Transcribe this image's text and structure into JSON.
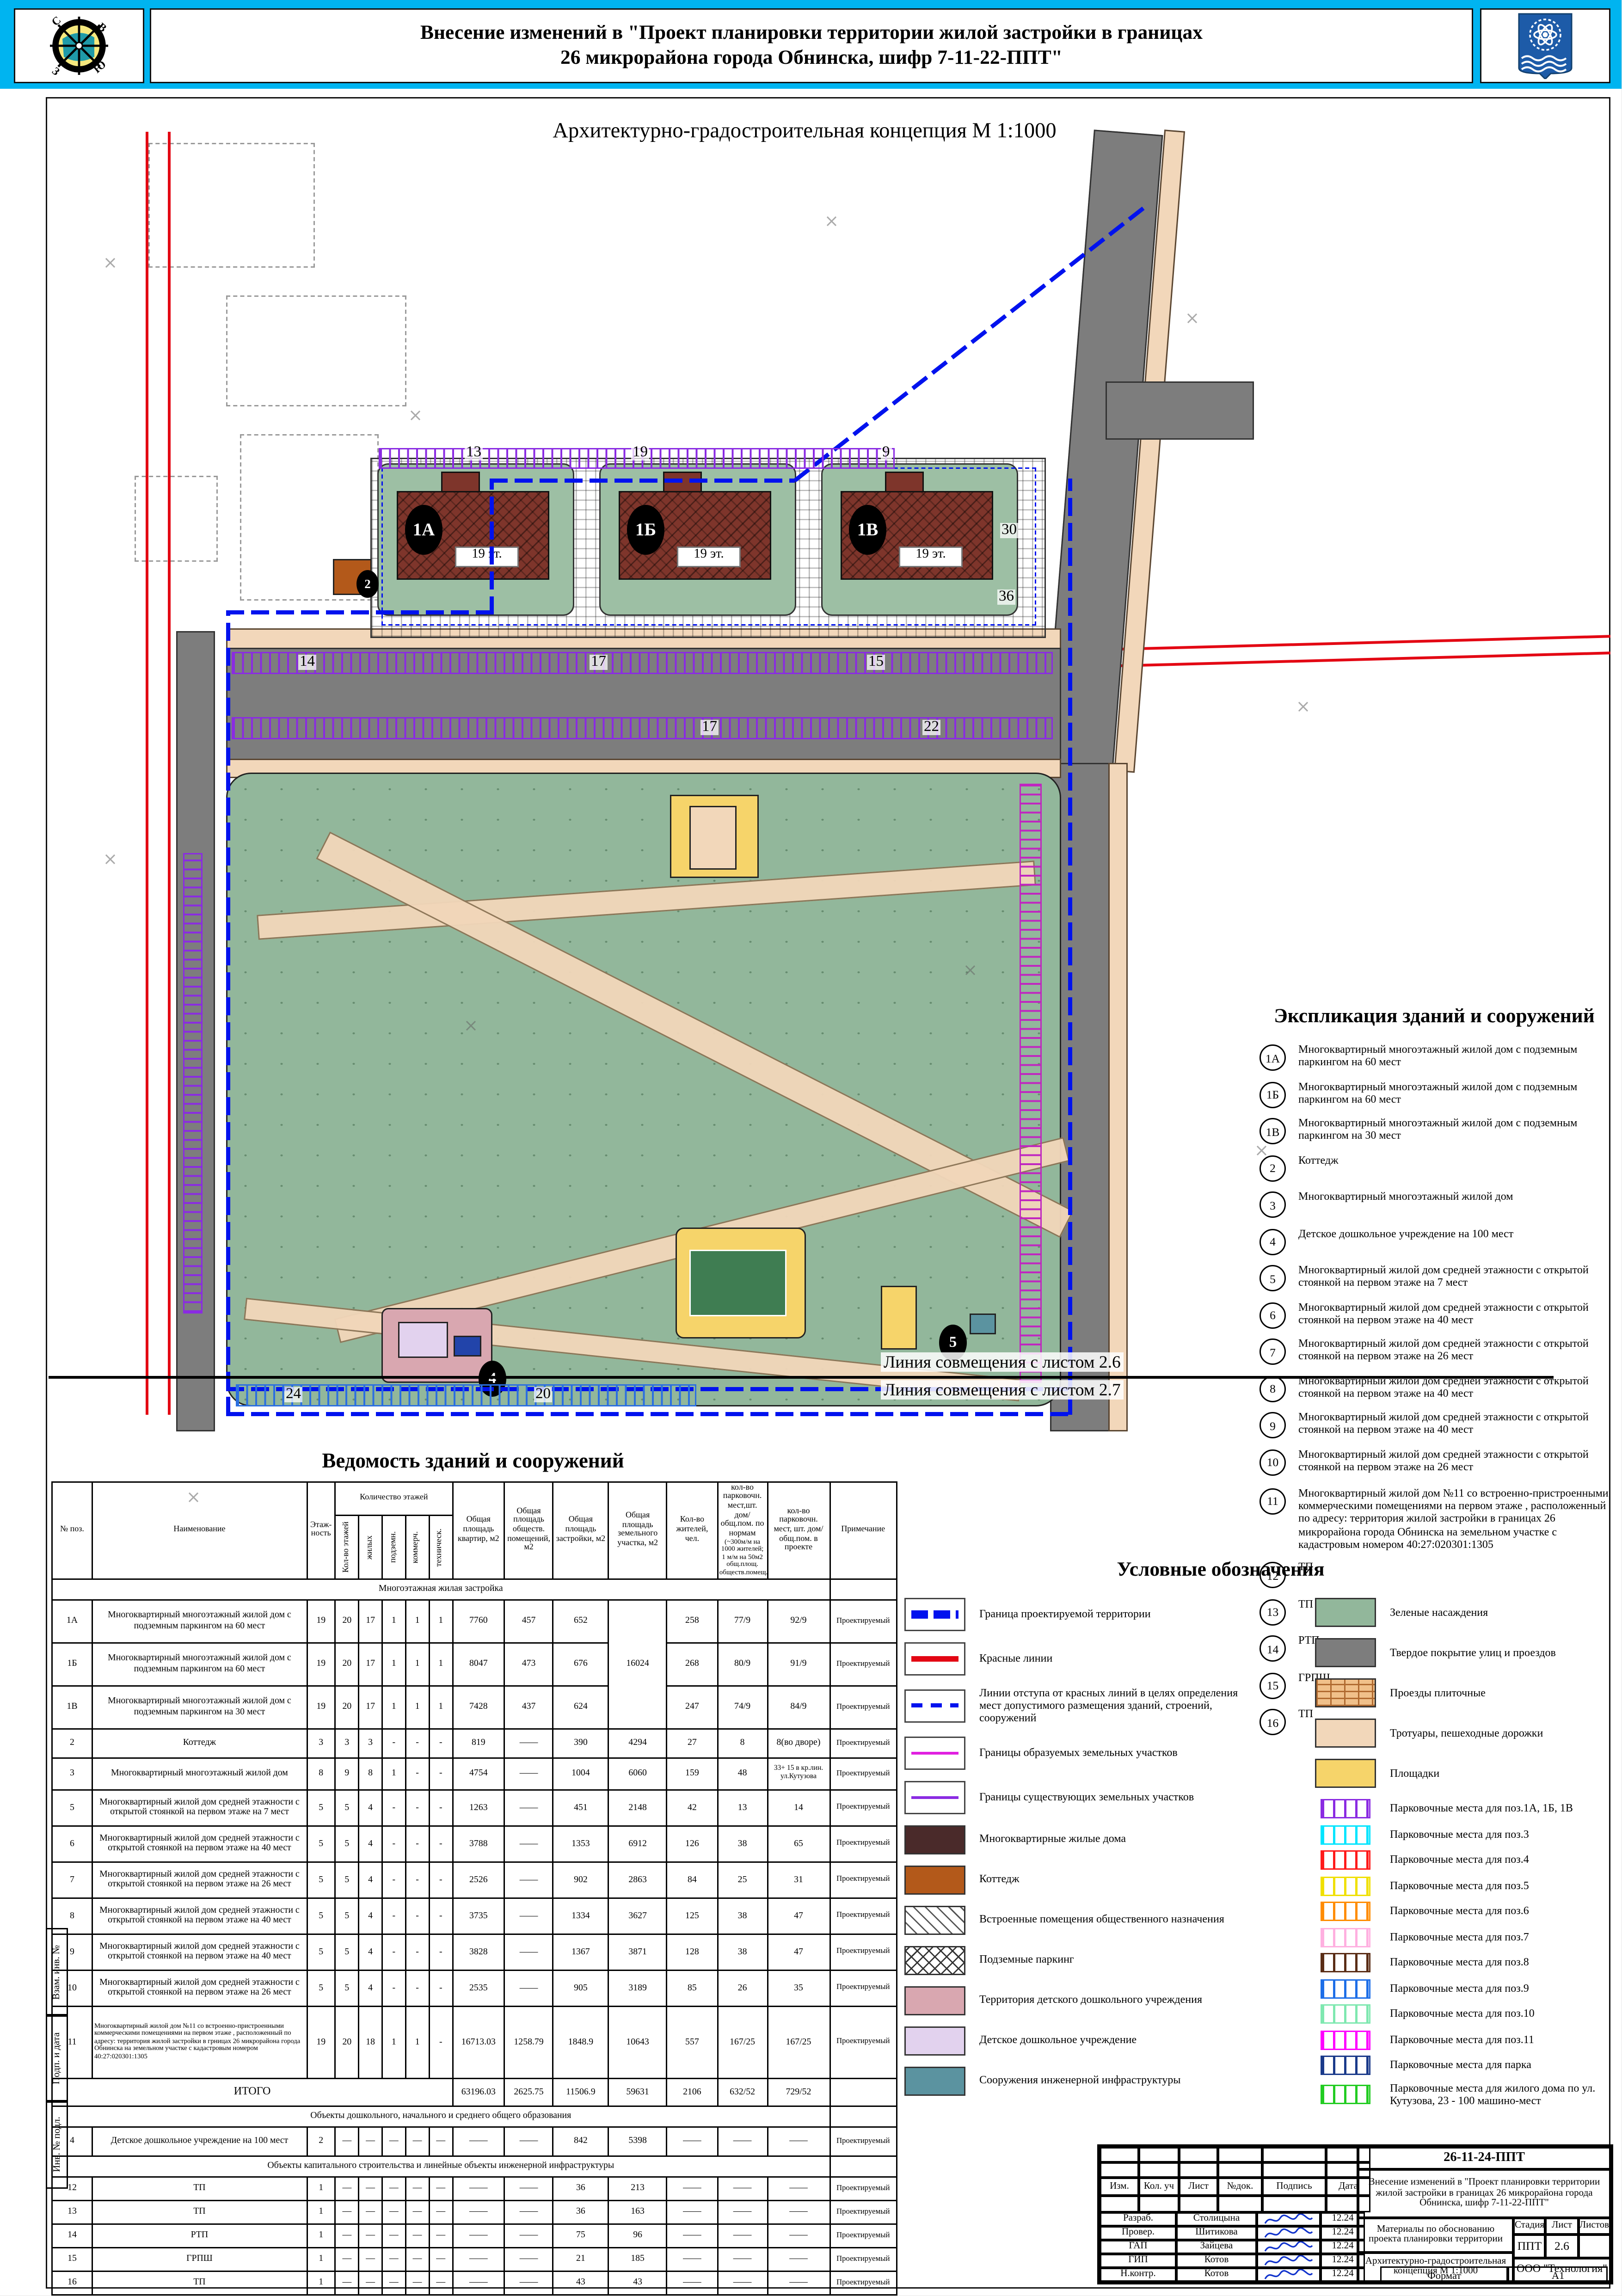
{
  "header": {
    "title_line1": "Внесение изменений в \"Проект планировки территории жилой застройки  в границах",
    "title_line2": "26 микрорайона города Обнинска, шифр 7-11-22-ППТ\"",
    "subtitle": "Архитектурно-градостроительная концепция М 1:1000",
    "compass_letters": [
      "С",
      "В",
      "З",
      "Ю"
    ],
    "accent_color": "#00b4f0"
  },
  "map": {
    "buildings": [
      {
        "label": "1А",
        "floors": "19 эт."
      },
      {
        "label": "1Б",
        "floors": "19 эт."
      },
      {
        "label": "1В",
        "floors": "19 эт."
      }
    ],
    "markers": [
      "2",
      "4",
      "5"
    ],
    "parking_numbers": [
      "13",
      "19",
      "9",
      "14",
      "17",
      "15",
      "17",
      "22",
      "36",
      "30",
      "24",
      "20"
    ],
    "match_line_top": "Линия совмещения с листом 2.6",
    "match_line_bottom": "Линия совмещения с листом 2.7",
    "colors": {
      "boundary_blue": "#0012ee",
      "red_line": "#e30613",
      "green": "#92b79b",
      "road_gray": "#7d7d7d",
      "walk_peach": "#f2d7ba",
      "building_red": "#7e352b",
      "cottage_orange": "#b3591a",
      "playground_yellow": "#f6d46a",
      "infra_teal": "#5b93a0",
      "ddu_pink": "#d9a7b0",
      "ddu_lavender": "#e2d2ee"
    }
  },
  "explication": {
    "title": "Экспликация зданий и сооружений",
    "items": [
      {
        "num": "1А",
        "text": "Многоквартирный многоэтажный жилой дом с подземным паркингом на 60 мест"
      },
      {
        "num": "1Б",
        "text": "Многоквартирный многоэтажный жилой дом с подземным паркингом на 60 мест"
      },
      {
        "num": "1В",
        "text": "Многоквартирный многоэтажный жилой дом с подземным паркингом на 30 мест"
      },
      {
        "num": "2",
        "text": "Коттедж"
      },
      {
        "num": "3",
        "text": "Многоквартирный многоэтажный жилой дом"
      },
      {
        "num": "4",
        "text": "Детское дошкольное учреждение на 100 мест"
      },
      {
        "num": "5",
        "text": "Многоквартирный  жилой дом средней этажности с открытой стоянкой на первом этаже на 7 мест"
      },
      {
        "num": "6",
        "text": "Многоквартирный  жилой дом средней этажности с открытой стоянкой на первом этаже на 40 мест"
      },
      {
        "num": "7",
        "text": "Многоквартирный  жилой дом средней этажности с открытой стоянкой на первом этаже на 26 мест"
      },
      {
        "num": "8",
        "text": "Многоквартирный  жилой дом средней этажности с открытой стоянкой на первом этаже на 40 мест"
      },
      {
        "num": "9",
        "text": "Многоквартирный  жилой дом средней этажности с открытой стоянкой на первом этаже на 40 мест"
      },
      {
        "num": "10",
        "text": "Многоквартирный  жилой дом средней этажности с открытой стоянкой на первом этаже на 26 мест"
      },
      {
        "num": "11",
        "text": "Многоквартирный жилой дом №11 со встроенно-пристроенными коммерческими помещениями на первом этаже , расположенный по адресу: территория жилой застройки в границах 26 микрорайона города Обнинска на земельном участке с кадастровым номером 40:27:020301:1305"
      },
      {
        "num": "12",
        "text": "ТП"
      },
      {
        "num": "13",
        "text": "ТП"
      },
      {
        "num": "14",
        "text": "РТП"
      },
      {
        "num": "15",
        "text": "ГРПШ"
      },
      {
        "num": "16",
        "text": "ТП"
      }
    ]
  },
  "vedomost": {
    "title": "Ведомость зданий и сооружений",
    "head": {
      "pos": "№ поз.",
      "name": "Наименование",
      "floors": "Этаж- ность",
      "floor_group": "Количество этажей",
      "floor_subs": [
        "Кол-во этажей",
        "жилых",
        "подземн.",
        "коммерч.",
        "техническ."
      ],
      "area_flats": "Общая площадь квартир, м2",
      "area_public": "Общая площадь обществ. помещений, м2",
      "area_built": "Общая площадь застройки, м2",
      "area_plot": "Общая площадь земельного участка, м2",
      "residents": "Кол-во жителей, чел.",
      "park_norm": "кол-во парковочн. мест,шт. дом/ общ.пом. по нормам",
      "park_norm_note": "(~300м/м на 1000 жителей; 1 м/м на 50м2 общ.площ. обществ.помещ.)",
      "park_proj": "кол-во парковочн. мест, шт. дом/ общ.пом. в проекте",
      "note": "Примечание"
    },
    "rows": [
      {
        "section": "Многоэтажная жилая застройка"
      },
      {
        "pos": "1А",
        "name": "Многоквартирный многоэтажный жилой дом с подземным паркингом на 60 мест",
        "fl": [
          "19",
          "20",
          "17",
          "1",
          "1",
          "1"
        ],
        "kv": "7760",
        "ob": "457",
        "za": "652",
        "uch": "16024",
        "uch_span": 3,
        "zh": "258",
        "pn": "77/9",
        "pp": "92/9",
        "note": "Проектируемый",
        "h": 31
      },
      {
        "pos": "1Б",
        "name": "Многоквартирный многоэтажный жилой дом с подземным паркингом на 60 мест",
        "fl": [
          "19",
          "20",
          "17",
          "1",
          "1",
          "1"
        ],
        "kv": "8047",
        "ob": "473",
        "za": "676",
        "uch": null,
        "zh": "268",
        "pn": "80/9",
        "pp": "91/9",
        "note": "Проектируемый",
        "h": 31
      },
      {
        "pos": "1В",
        "name": "Многоквартирный многоэтажный жилой дом с подземным паркингом на 30 мест",
        "fl": [
          "19",
          "20",
          "17",
          "1",
          "1",
          "1"
        ],
        "kv": "7428",
        "ob": "437",
        "za": "624",
        "uch": null,
        "zh": "247",
        "pn": "74/9",
        "pp": "84/9",
        "note": "Проектируемый",
        "h": 31
      },
      {
        "pos": "2",
        "name": "Коттедж",
        "fl": [
          "3",
          "3",
          "3",
          "-",
          "-",
          "-"
        ],
        "kv": "819",
        "ob": "——",
        "za": "390",
        "uch": "4294",
        "zh": "27",
        "pn": "8",
        "pp": "8(во дворе)",
        "note": "Проектируемый",
        "h": 21
      },
      {
        "pos": "3",
        "name": "Многоквартирный многоэтажный жилой дом",
        "fl": [
          "8",
          "9",
          "8",
          "1",
          "-",
          "-"
        ],
        "kv": "4754",
        "ob": "——",
        "za": "1004",
        "uch": "6060",
        "zh": "159",
        "pn": "48",
        "pp": "33+ 15 в кр.лин. ул.Кутузова",
        "note": "Проектируемый",
        "h": 23,
        "pp_small": true
      },
      {
        "pos": "5",
        "name": "Многоквартирный  жилой дом средней этажности с открытой стоянкой на первом этаже на 7 мест",
        "fl": [
          "5",
          "5",
          "4",
          "-",
          "-",
          "-"
        ],
        "kv": "1263",
        "ob": "——",
        "za": "451",
        "uch": "2148",
        "zh": "42",
        "pn": "13",
        "pp": "14",
        "note": "Проектируемый",
        "h": 26
      },
      {
        "pos": "6",
        "name": "Многоквартирный  жилой дом средней этажности с открытой стоянкой на первом этаже на 40 мест",
        "fl": [
          "5",
          "5",
          "4",
          "-",
          "-",
          "-"
        ],
        "kv": "3788",
        "ob": "——",
        "za": "1353",
        "uch": "6912",
        "zh": "126",
        "pn": "38",
        "pp": "65",
        "note": "Проектируемый",
        "h": 26
      },
      {
        "pos": "7",
        "name": "Многоквартирный  жилой дом средней этажности с открытой стоянкой на первом этаже на 26 мест",
        "fl": [
          "5",
          "5",
          "4",
          "-",
          "-",
          "-"
        ],
        "kv": "2526",
        "ob": "——",
        "za": "902",
        "uch": "2863",
        "zh": "84",
        "pn": "25",
        "pp": "31",
        "note": "Проектируемый",
        "h": 26
      },
      {
        "pos": "8",
        "name": "Многоквартирный  жилой дом средней этажности с открытой стоянкой на первом этаже на 40 мест",
        "fl": [
          "5",
          "5",
          "4",
          "-",
          "-",
          "-"
        ],
        "kv": "3735",
        "ob": "——",
        "za": "1334",
        "uch": "3627",
        "zh": "125",
        "pn": "38",
        "pp": "47",
        "note": "Проектируемый",
        "h": 26
      },
      {
        "pos": "9",
        "name": "Многоквартирный  жилой дом средней этажности с открытой стоянкой на первом этаже на 40 мест",
        "fl": [
          "5",
          "5",
          "4",
          "-",
          "-",
          "-"
        ],
        "kv": "3828",
        "ob": "——",
        "za": "1367",
        "uch": "3871",
        "zh": "128",
        "pn": "38",
        "pp": "47",
        "note": "Проектируемый",
        "h": 26
      },
      {
        "pos": "10",
        "name": "Многоквартирный  жилой дом средней этажности с открытой стоянкой на первом этаже на 26 мест",
        "fl": [
          "5",
          "5",
          "4",
          "-",
          "-",
          "-"
        ],
        "kv": "2535",
        "ob": "——",
        "za": "905",
        "uch": "3189",
        "zh": "85",
        "pn": "26",
        "pp": "35",
        "note": "Проектируемый",
        "h": 26
      },
      {
        "pos": "11",
        "name": "Многоквартирный жилой дом №11 со встроенно-пристроенными коммерческими помещениями на первом этаже , расположенный по адресу: территория жилой застройки в грницах 26 микрорайона города Обнинска на земельном участке с кадастровым номером 40:27:020301:1305",
        "fl": [
          "19",
          "20",
          "18",
          "1",
          "1",
          "-"
        ],
        "kv": "16713.03",
        "ob": "1258.79",
        "za": "1848.9",
        "uch": "10643",
        "zh": "557",
        "pn": "167/25",
        "pp": "167/25",
        "note": "Проектируемый",
        "h": 52,
        "name_small": true
      },
      {
        "itogo": "ИТОГО",
        "kv": "63196.03",
        "ob": "2625.75",
        "za": "11506.9",
        "uch": "59631",
        "zh": "2106",
        "pn": "632/52",
        "pp": "729/52",
        "h": 20
      },
      {
        "section": "Объекты дошкольного, начального и среднего общего образования"
      },
      {
        "pos": "4",
        "name": "Детское дошкольное учреждение на 100 мест",
        "fl": [
          "2",
          "—",
          "—",
          "—",
          "—",
          "—"
        ],
        "kv": "——",
        "ob": "——",
        "za": "842",
        "uch": "5398",
        "zh": "——",
        "pn": "——",
        "pp": "——",
        "note": "Проектируемый",
        "h": 21
      },
      {
        "section": "Объекты капитального строительства и линейные объекты инженерной инфраструктуры"
      },
      {
        "pos": "12",
        "name": "ТП",
        "fl": [
          "1",
          "—",
          "—",
          "—",
          "—",
          "—"
        ],
        "kv": "——",
        "ob": "——",
        "za": "36",
        "uch": "213",
        "zh": "——",
        "pn": "——",
        "pp": "——",
        "note": "Проектируемый",
        "h": 17
      },
      {
        "pos": "13",
        "name": "ТП",
        "fl": [
          "1",
          "—",
          "—",
          "—",
          "—",
          "—"
        ],
        "kv": "——",
        "ob": "——",
        "za": "36",
        "uch": "163",
        "zh": "——",
        "pn": "——",
        "pp": "——",
        "note": "Проектируемый",
        "h": 17
      },
      {
        "pos": "14",
        "name": "РТП",
        "fl": [
          "1",
          "—",
          "—",
          "—",
          "—",
          "—"
        ],
        "kv": "——",
        "ob": "——",
        "za": "75",
        "uch": "96",
        "zh": "——",
        "pn": "——",
        "pp": "——",
        "note": "Проектируемый",
        "h": 17
      },
      {
        "pos": "15",
        "name": "ГРПШ",
        "fl": [
          "1",
          "—",
          "—",
          "—",
          "—",
          "—"
        ],
        "kv": "——",
        "ob": "——",
        "za": "21",
        "uch": "185",
        "zh": "——",
        "pn": "——",
        "pp": "——",
        "note": "Проектируемый",
        "h": 17
      },
      {
        "pos": "16",
        "name": "ТП",
        "fl": [
          "1",
          "—",
          "—",
          "—",
          "—",
          "—"
        ],
        "kv": "——",
        "ob": "——",
        "za": "43",
        "uch": "43",
        "zh": "——",
        "pn": "——",
        "pp": "——",
        "note": "Проектируемый",
        "h": 17
      }
    ]
  },
  "legend": {
    "title": "Условные обозначения",
    "left": [
      {
        "type": "line-bold-dashdot",
        "color": "#0012ee",
        "label": "Граница проектируемой территории"
      },
      {
        "type": "line-solid",
        "color": "#e30613",
        "label": "Красные линии"
      },
      {
        "type": "line-dash",
        "color": "#0012ee",
        "label": "Линии отступа от красных линий в целях определения мест допустимого размещения зданий, строений, сооружений"
      },
      {
        "type": "line-solid-thin",
        "color": "#e020e0",
        "label": "Границы образуемых земельных участков"
      },
      {
        "type": "line-solid-thin",
        "color": "#8a2be2",
        "label": "Границы существующих земельных участков"
      },
      {
        "type": "fill",
        "color": "#4a2a2a",
        "label": "Многоквартирные жилые дома"
      },
      {
        "type": "fill",
        "color": "#b3591a",
        "label": "Коттедж"
      },
      {
        "type": "hatch-diag",
        "color": "#555555",
        "label": "Встроенные помещения общественного назначения"
      },
      {
        "type": "hatch-cross",
        "color": "#333333",
        "label": "Подземные паркинг"
      },
      {
        "type": "fill",
        "color": "#d9a7b0",
        "label": "Территория детского дошкольного учреждения"
      },
      {
        "type": "fill",
        "color": "#e2d2ee",
        "label": "Детское дошкольное учреждение"
      },
      {
        "type": "fill",
        "color": "#5b93a0",
        "label": "Сооружения инженерной инфраструктуры"
      }
    ],
    "right": [
      {
        "type": "fill",
        "color": "#92b79b",
        "label": "Зеленые насаждения"
      },
      {
        "type": "fill",
        "color": "#7d7d7d",
        "label": "Твердое покрытие улиц и проездов"
      },
      {
        "type": "brick",
        "color": "#b06a30",
        "label": "Проезды плиточные"
      },
      {
        "type": "fill",
        "color": "#f2d7ba",
        "label": "Тротуары, пешеходные дорожки"
      },
      {
        "type": "fill",
        "color": "#f6d46a",
        "label": "Площадки"
      },
      {
        "type": "ticks",
        "color": "#8a2be2",
        "label": "Парковочные места для поз.1А, 1Б, 1В"
      },
      {
        "type": "ticks",
        "color": "#00e5ff",
        "label": "Парковочные места для поз.3"
      },
      {
        "type": "ticks",
        "color": "#ff1a1a",
        "label": "Парковочные места для поз.4"
      },
      {
        "type": "ticks",
        "color": "#f0e000",
        "label": "Парковочные места для поз.5"
      },
      {
        "type": "ticks",
        "color": "#ff8c00",
        "label": "Парковочные места для поз.6"
      },
      {
        "type": "ticks",
        "color": "#ffb0e0",
        "label": "Парковочные места для поз.7"
      },
      {
        "type": "ticks",
        "color": "#5a2d16",
        "label": "Парковочные места для поз.8"
      },
      {
        "type": "ticks",
        "color": "#1e6fe8",
        "label": "Парковочные места для поз.9"
      },
      {
        "type": "ticks",
        "color": "#7fe8b0",
        "label": "Парковочные места для поз.10"
      },
      {
        "type": "ticks",
        "color": "#ff00ff",
        "label": "Парковочные места для поз.11"
      },
      {
        "type": "ticks",
        "color": "#1a3a8a",
        "label": "Парковочные места для парка"
      },
      {
        "type": "ticks",
        "color": "#22cc22",
        "label": "Парковочные места для жилого дома по ул. Кутузова, 23 - 100 машино-мест"
      }
    ]
  },
  "stamp": {
    "doc_code": "26-11-24-ППТ",
    "object_title": "Внесение изменений в \"Проект планировки территории жилой застройки в границах 26 микрорайона города Обнинска, шифр 7-11-22-ППТ\"",
    "cols": [
      "Изм.",
      "Кол. уч",
      "Лист",
      "№док.",
      "Подпись",
      "Дата"
    ],
    "roles": [
      {
        "role": "Разраб.",
        "name": "Столицына",
        "date": "12.24"
      },
      {
        "role": "Провер.",
        "name": "Шитикова",
        "date": "12.24"
      },
      {
        "role": "ГАП",
        "name": "Зайцева",
        "date": "12.24"
      },
      {
        "role": "ГИП",
        "name": "Котов",
        "date": "12.24"
      },
      {
        "role": "Н.контр.",
        "name": "Котов",
        "date": "12.24"
      }
    ],
    "doc1": "Материалы по обоснованию проекта планировки территории",
    "doc2": "Архитектурно-градостроительная концепция М 1:1000",
    "stage_head": [
      "Стадия",
      "Лист",
      "Листов"
    ],
    "stage_vals": [
      "ППТ",
      "2.6",
      ""
    ],
    "company": "ООО \"Технология\"",
    "format_label": "Формат",
    "format_value": "А1",
    "margin_labels": [
      "Взам. инв. №",
      "Подп. и дата",
      "Инв. № подл."
    ]
  }
}
